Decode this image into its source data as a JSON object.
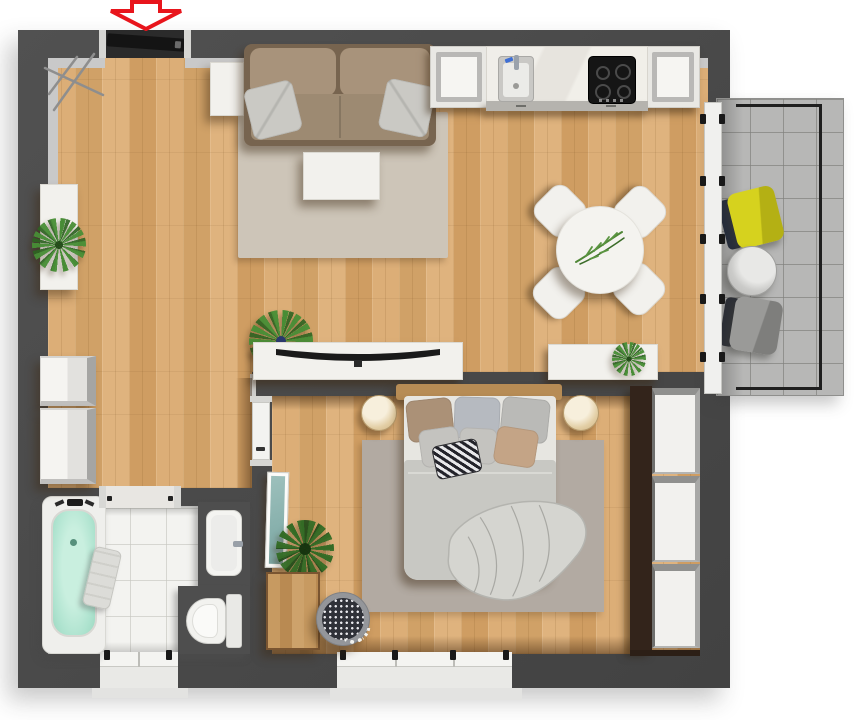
{
  "scene": {
    "type": "apartment-floor-plan-3d-top-view",
    "background": "#ffffff"
  },
  "colors": {
    "wall": "#4a4a4a",
    "wall_lining": "#c9c9c9",
    "wood_floor": "#d7a76f",
    "bath_tile": "#f3f3f0",
    "balcony_floor": "#b7b7b6",
    "railing_black": "#1f1f1f",
    "rug_living": "#cdc5b8",
    "rug_bedroom": "#b2aaa2",
    "sofa_frame": "#77644f",
    "sofa_cushion": "#a8937b",
    "pillow_gray": "#cac9c4",
    "furniture_white": "#f2f1ed",
    "furniture_border": "#dbd9d2",
    "tv_black": "#1a1a1a",
    "plant_green": "#488e36",
    "headboard_wood": "#b78c55",
    "duvet_gray": "#c8c8c3",
    "sheet_white": "#e7e6e1",
    "pillow_brown": "#ab9177",
    "pillow_blue_gray": "#b6bac0",
    "pillow_tan": "#c4a486",
    "accent_yellow": "#d6d21e",
    "balcony_chair_gray": "#9a9a98",
    "chair_back_dark": "#262d3b",
    "tub_mint": "#aee3cf",
    "alcove_dark": "#4e4e4e",
    "dresser_wood": "#c2945c",
    "mirror_teal": "#87b0ac",
    "dark_wood_trim": "#33241b",
    "door_black": "#141414",
    "arrow_red": "#e8151c",
    "sill": "#e3e3e1"
  },
  "rooms": [
    {
      "id": "living-room",
      "floor": "wood",
      "furniture": [
        "sofa",
        "sofa-pillows",
        "side-table",
        "coffee-table",
        "area-rug",
        "tv-sideboard",
        "curved-tv",
        "floor-plant",
        "wall-sideboard-with-plant",
        "storage-cabinets",
        "coat-rack"
      ]
    },
    {
      "id": "kitchen",
      "floor": "wood",
      "furniture": [
        "left-cabinet",
        "counter",
        "sink-with-faucet",
        "induction-cooktop",
        "right-cabinet"
      ]
    },
    {
      "id": "dining-area",
      "floor": "wood",
      "furniture": [
        "round-table",
        "chairs",
        "table-plant",
        "sideboard-with-plant"
      ]
    },
    {
      "id": "bedroom",
      "floor": "wood",
      "furniture": [
        "double-bed",
        "headboard",
        "pillows",
        "accent-pillow",
        "rumpled-blanket",
        "nightstand-left",
        "nightstand-right",
        "area-rug",
        "wardrobe",
        "dresser",
        "leaning-mirror",
        "potted-plant",
        "patterned-pouf"
      ]
    },
    {
      "id": "bathroom",
      "floor": "tile",
      "furniture": [
        "bathtub",
        "tub-faucet",
        "towel",
        "washbasin",
        "toilet"
      ]
    },
    {
      "id": "balcony",
      "floor": "tile",
      "furniture": [
        "yellow-armchair",
        "round-side-table",
        "gray-armchair",
        "railing"
      ]
    }
  ],
  "openings": {
    "entrance_door": "top wall, black leaf, marked by red arrow",
    "balcony_door": "right wall, white glass panels with black handles",
    "bedroom_door": "white leaf in bedroom left wall",
    "bathroom_door": "opening in bathroom top wall",
    "bathroom_window": "bottom wall, 2 panes",
    "bedroom_window": "bottom wall, 3 panes"
  },
  "counts": {
    "dining_chairs": 4,
    "cooktop_burners": 4,
    "wardrobe_sections": 3,
    "balcony_door_handle_pairs": 5,
    "bed_pillows": 7,
    "sofa_pillows": 2
  },
  "annotations": {
    "entrance_arrow": {
      "shape": "down-arrow-outline",
      "color": "#e8151c",
      "fill": "#ffffff"
    }
  }
}
